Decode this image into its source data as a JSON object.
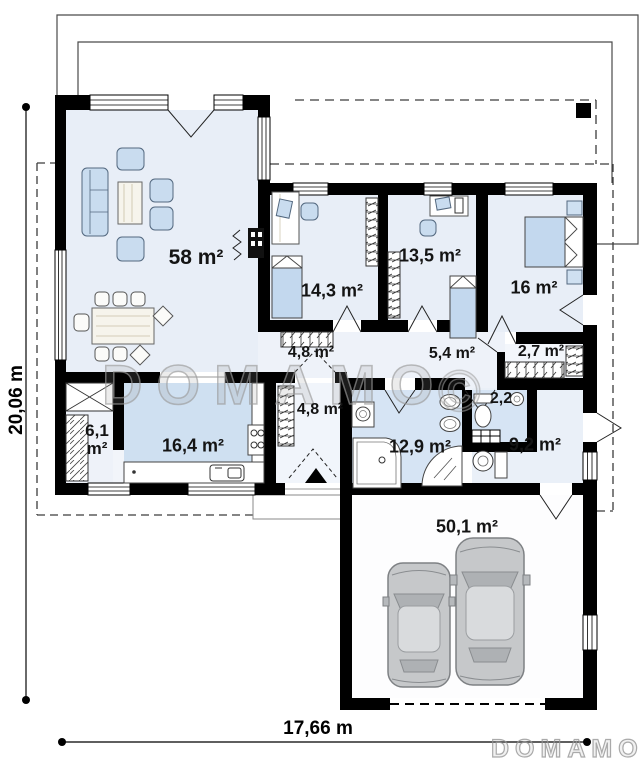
{
  "watermark": {
    "large": "DOMAMO",
    "symbol": "©",
    "logo": "DOMAMO"
  },
  "dimensions": {
    "height": "20,06 m",
    "width": "17,66 m"
  },
  "rooms": {
    "living": {
      "area": "58 m²"
    },
    "bedroom1": {
      "area": "14,3 m²"
    },
    "bedroom2": {
      "area": "13,5 m²"
    },
    "bedroom3": {
      "area": "16 m²"
    },
    "corridor1": {
      "area": "4,8 m²"
    },
    "corridor2": {
      "area": "5,4 m²"
    },
    "closet": {
      "area": "2,7 m²"
    },
    "wc": {
      "area": "2,2"
    },
    "utility": {
      "area": "6,1 m²"
    },
    "kitchen": {
      "area": "16,4 m²"
    },
    "vestibule": {
      "area": "4,8 m²"
    },
    "bathroom": {
      "area": "12,9 m²"
    },
    "hall": {
      "area": "9,2 m²"
    },
    "garage": {
      "area": "50,1 m²"
    }
  }
}
